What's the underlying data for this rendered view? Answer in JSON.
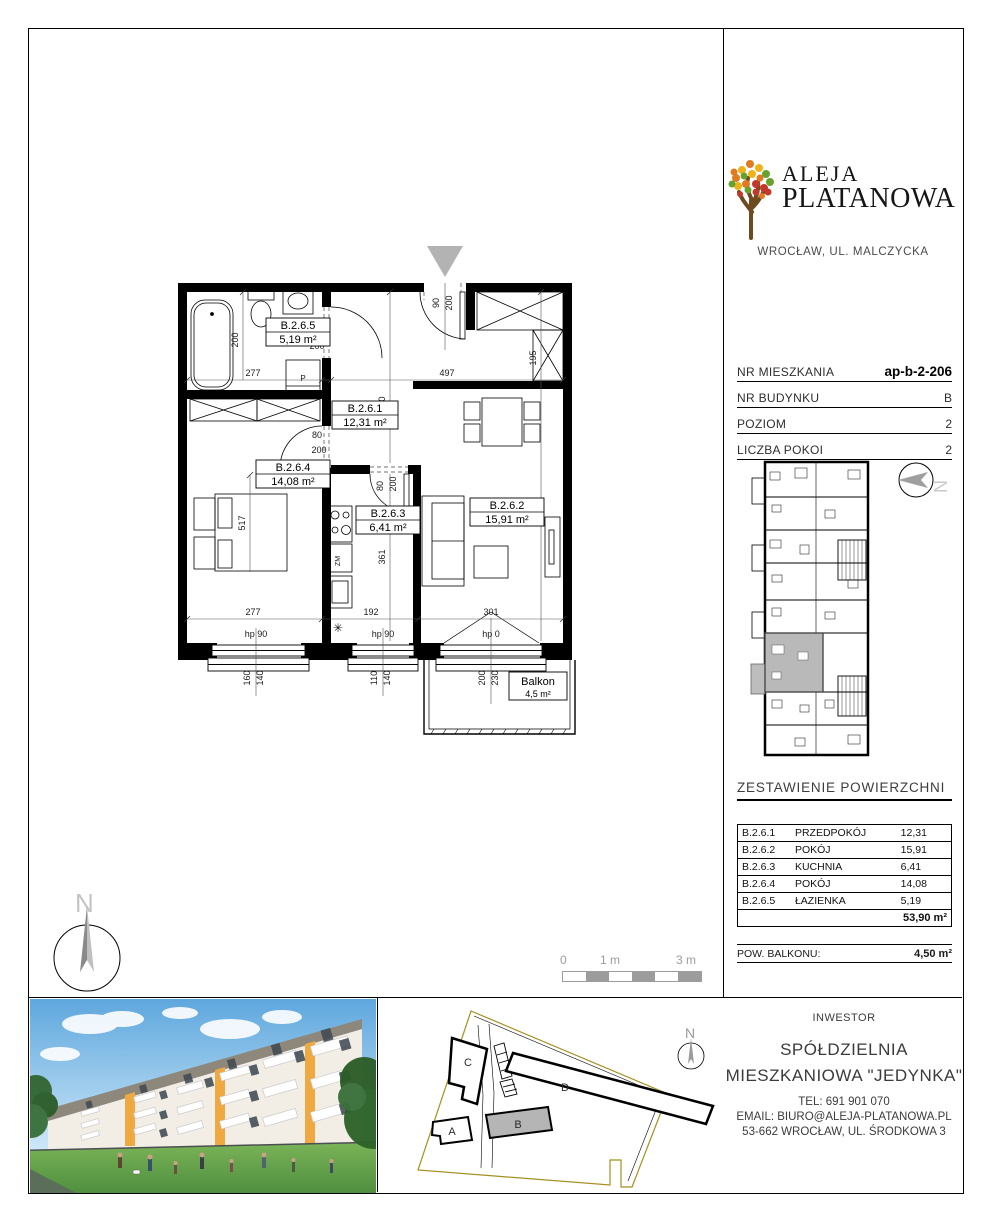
{
  "brand": {
    "line1": "ALEJA",
    "line2": "PLATANOWA",
    "city": "WROCŁAW, UL. MALCZYCKA"
  },
  "details": {
    "rows": [
      {
        "label": "NR MIESZKANIA",
        "value": "ap-b-2-206"
      },
      {
        "label": "NR BUDYNKU",
        "value": "B"
      },
      {
        "label": "POZIOM",
        "value": "2"
      },
      {
        "label": "LICZBA POKOI",
        "value": "2"
      }
    ]
  },
  "areas": {
    "title": "ZESTAWIENIE POWIERZCHNI",
    "rows": [
      {
        "id": "B.2.6.1",
        "name": "PRZEDPOKÓJ",
        "area": "12,31"
      },
      {
        "id": "B.2.6.2",
        "name": "POKÓJ",
        "area": "15,91"
      },
      {
        "id": "B.2.6.3",
        "name": "KUCHNIA",
        "area": "6,41"
      },
      {
        "id": "B.2.6.4",
        "name": "POKÓJ",
        "area": "14,08"
      },
      {
        "id": "B.2.6.5",
        "name": "ŁAZIENKA",
        "area": "5,19"
      }
    ],
    "total": "53,90 m²",
    "balcony_label": "POW. BALKONU:",
    "balcony_value": "4,50 m²"
  },
  "plan": {
    "rooms": {
      "r1": {
        "id": "B.2.6.1",
        "area": "12,31 m²"
      },
      "r2": {
        "id": "B.2.6.2",
        "area": "15,91 m²"
      },
      "r3": {
        "id": "B.2.6.3",
        "area": "6,41 m²"
      },
      "r4": {
        "id": "B.2.6.4",
        "area": "14,08 m²"
      },
      "r5": {
        "id": "B.2.6.5",
        "area": "5,19 m²"
      },
      "balcony": {
        "name": "Balkon",
        "area": "4,5 m²"
      }
    },
    "dims": {
      "d80": "80",
      "d90": "90",
      "d110": "110",
      "d140": "140",
      "d160": "160",
      "d192": "192",
      "d195": "195",
      "d200": "200",
      "d230": "230",
      "d277": "277",
      "d301": "301",
      "d360": "360",
      "d361": "361",
      "d497": "497",
      "d517": "517",
      "d536": "536",
      "hp90": "hp 90",
      "hp0": "hp 0"
    },
    "symbols": {
      "washer": "P",
      "sink": "ZM",
      "vent": "✳"
    }
  },
  "scalebar": {
    "zero": "0",
    "one": "1 m",
    "three": "3 m"
  },
  "compass": {
    "letter": "N"
  },
  "siteplan": {
    "a": "A",
    "b": "B",
    "c": "C",
    "d": "D"
  },
  "investor": {
    "caption": "INWESTOR",
    "name1": "SPÓŁDZIELNIA",
    "name2": "MIESZKANIOWA \"JEDYNKA\"",
    "tel": "TEL:  691 901 070",
    "email": "EMAIL: BIURO@ALEJA-PLATANOWA.PL",
    "address": "53-662 WROCŁAW, UL. ŚRODKOWA 3"
  }
}
